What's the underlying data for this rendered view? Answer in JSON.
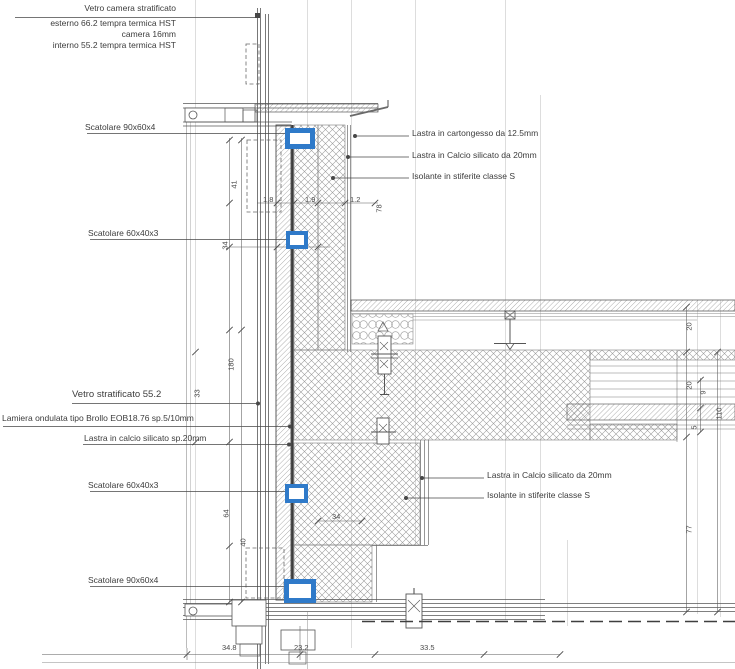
{
  "colors": {
    "highlight_blue": "#2F7AC9",
    "line_dark": "#4a4a4a",
    "line_light": "#c2c2c2"
  },
  "glass_spec": {
    "title": "Vetro camera stratificato",
    "line2": "esterno 66.2 tempra termica HST",
    "line3": "camera 16mm",
    "line4": "interno 55.2 tempra termica HST"
  },
  "callouts": {
    "left": [
      {
        "id": "scatolare-90x60x4-top",
        "text": "Scatolare 90x60x4"
      },
      {
        "id": "scatolare-60x40x3-top",
        "text": "Scatolare 60x40x3"
      },
      {
        "id": "vetro-stratificato",
        "text": "Vetro stratificato 55.2"
      },
      {
        "id": "lamiera-ondulata",
        "text": "Lamiera ondulata tipo Brollo EOB18.76 sp.5/10mm"
      },
      {
        "id": "lastra-calcio-sp20",
        "text": "Lastra in calcio silicato sp.20mm"
      },
      {
        "id": "scatolare-60x40x3-bottom",
        "text": "Scatolare 60x40x3"
      },
      {
        "id": "scatolare-90x60x4-bottom",
        "text": "Scatolare 90x60x4"
      }
    ],
    "right_upper": [
      {
        "id": "cartongesso-125",
        "text": "Lastra in cartongesso da 12.5mm"
      },
      {
        "id": "calcio-20-top",
        "text": "Lastra in Calcio silicato da 20mm"
      },
      {
        "id": "isolante-top",
        "text": "Isolante in stiferite classe S"
      }
    ],
    "right_lower": [
      {
        "id": "calcio-20-bottom",
        "text": "Lastra in Calcio silicato da 20mm"
      },
      {
        "id": "isolante-bottom",
        "text": "Isolante in stiferite classe S"
      }
    ]
  },
  "dimensions": {
    "bottom": [
      "34.8",
      "23.2",
      "33.5"
    ],
    "left_vertical": [
      "41",
      "34",
      "180",
      "33",
      "64",
      "40"
    ],
    "wall_top": [
      "1.8",
      "1.9",
      "1.2",
      "78"
    ],
    "wall_mid": [
      "6.2",
      "34"
    ],
    "right_vertical": [
      "20",
      "20",
      "9",
      "5",
      "110",
      "77"
    ]
  }
}
